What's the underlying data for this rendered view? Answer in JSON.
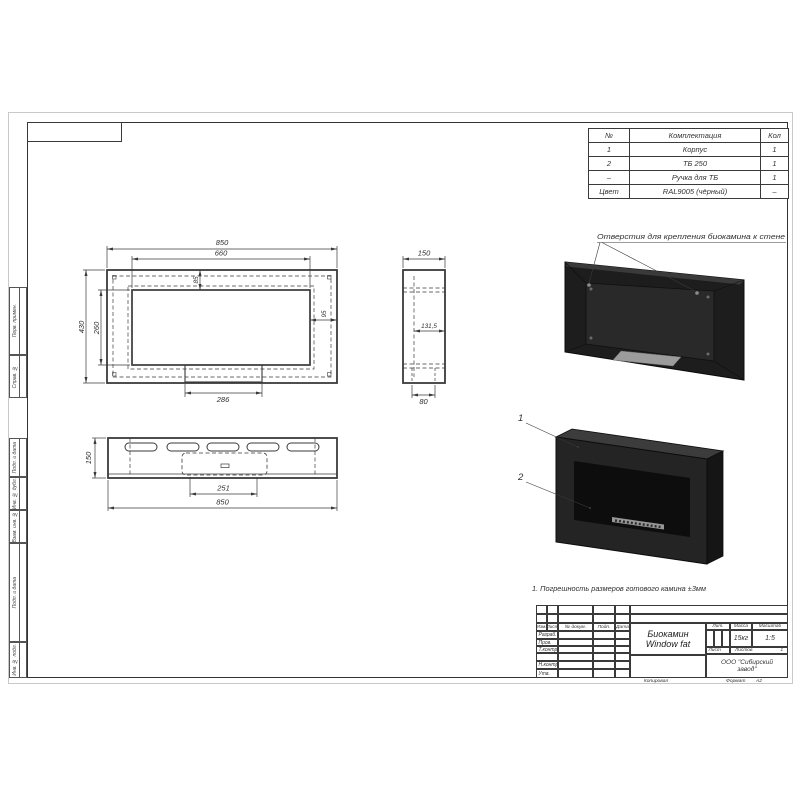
{
  "sheet": {
    "margin_labels": [
      "Перв. примен.",
      "Справ. №",
      "Подп. и дата",
      "Инв. № дубл.",
      "Взам. инв. №",
      "Подп. и дата",
      "Инв. № подл."
    ]
  },
  "parts_table": {
    "headers": [
      "№",
      "Комплектация",
      "Кол"
    ],
    "rows": [
      [
        "1",
        "Корпус",
        "1"
      ],
      [
        "2",
        "ТБ 250",
        "1"
      ],
      [
        "–",
        "Ручка для ТБ",
        "1"
      ],
      [
        "Цвет",
        "RAL9005 (чёрный)",
        "–"
      ]
    ]
  },
  "dimensions": {
    "front": {
      "width": "850",
      "opening_width": "660",
      "height": "430",
      "opening_height": "260",
      "opening_top_offset": "85",
      "opening_side_offset": "95",
      "slot_width": "286"
    },
    "side": {
      "depth": "150",
      "inner_depth": "131,5",
      "slot_depth": "80"
    },
    "bottom": {
      "depth": "150",
      "burner_width": "251",
      "width": "850"
    }
  },
  "annotations": {
    "mounting_holes": "Отверстия для крепления биокамина к стене",
    "tolerance_note": "1. Погрешность размеров готового камина ±3мм",
    "callout_1": "1",
    "callout_2": "2"
  },
  "title_block": {
    "revision_headers": [
      "Изм.",
      "Лист",
      "№ докум.",
      "Подп.",
      "Дата"
    ],
    "role_labels": [
      "Разраб.",
      "Пров.",
      "Т.контр.",
      "Н.контр.",
      "Утв."
    ],
    "doc_title_line1": "Биокамин",
    "doc_title_line2": "Window fat",
    "lit_label": "Лит.",
    "mass_label": "Масса",
    "scale_label": "Масштаб",
    "mass_value": "15кг",
    "scale_value": "1:5",
    "sheet_label": "Лист",
    "sheets_label": "Листов",
    "sheets_value": "1",
    "company": "ООО \"Сибирский завод\"",
    "copied_label": "Копировал",
    "format_label": "Формат",
    "format_value": "А2"
  },
  "colors": {
    "fireplace_body": "#1e1e1e",
    "drawing_line": "#3a3a3a",
    "burner_tray": "#9c9c9c"
  }
}
